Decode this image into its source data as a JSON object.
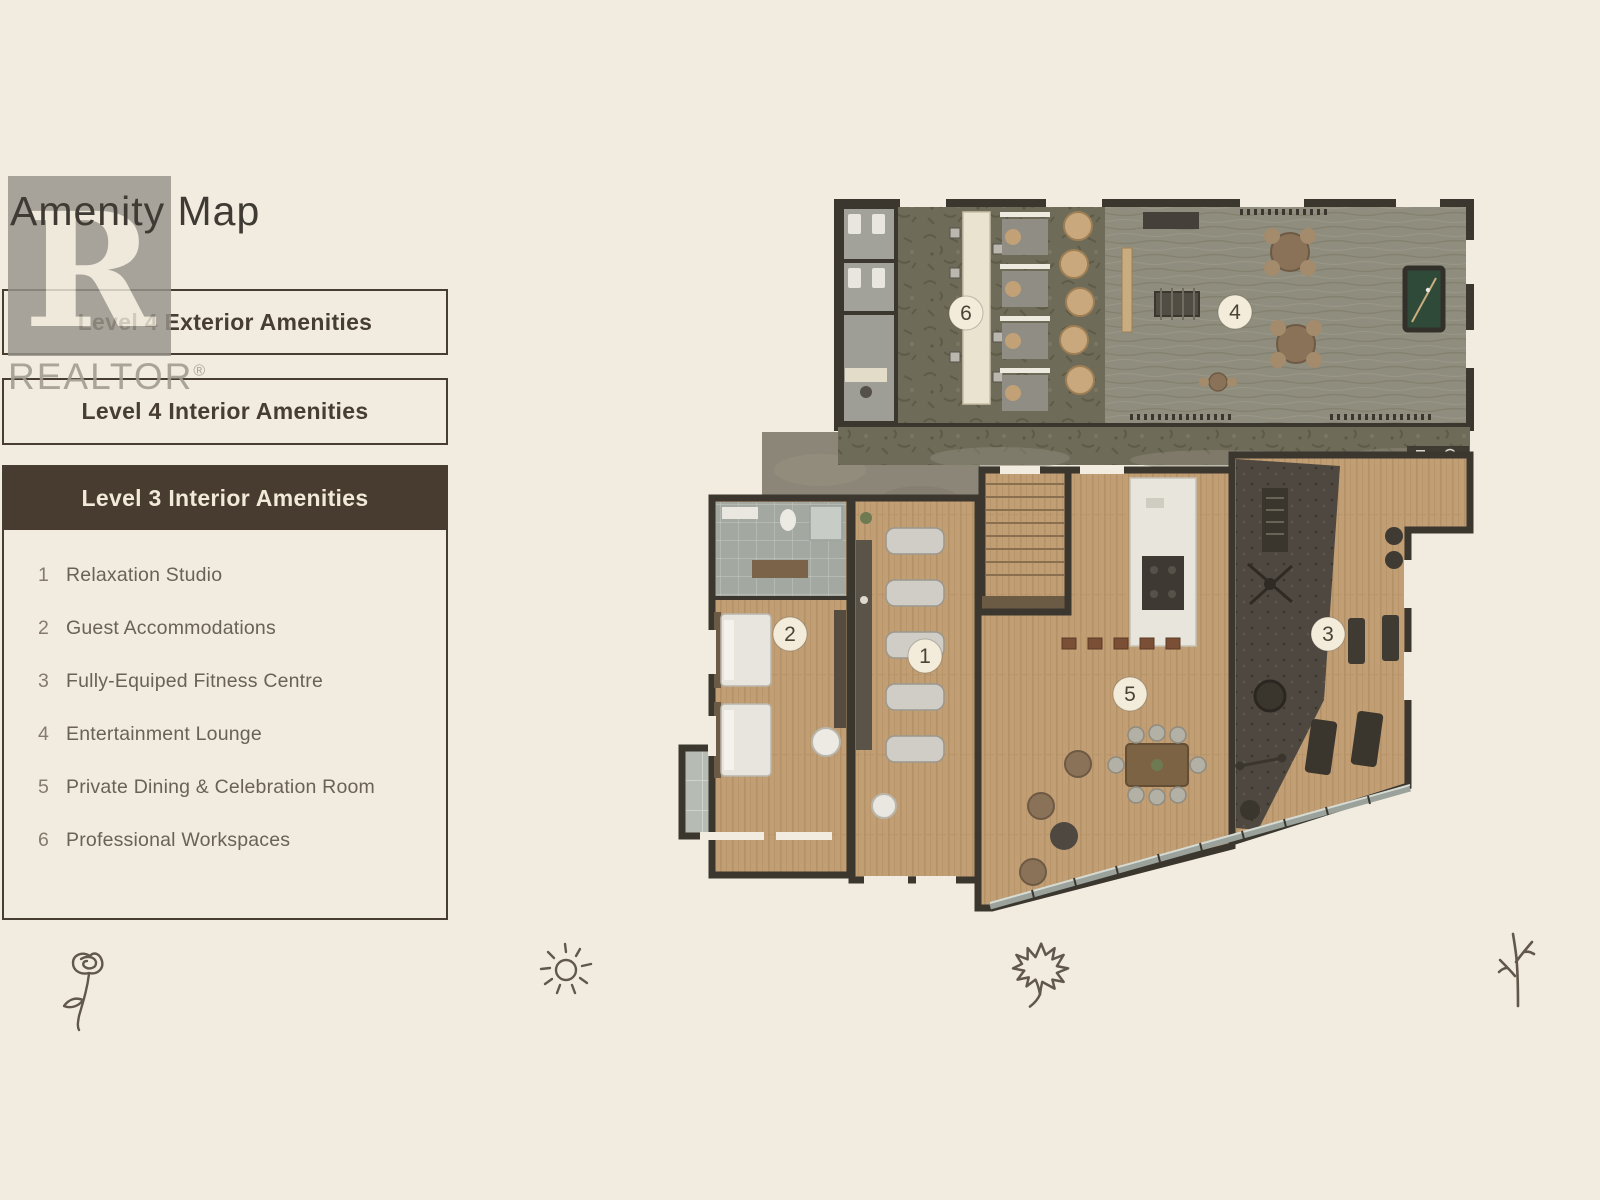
{
  "page": {
    "title": "Amenity Map"
  },
  "watermark": {
    "letter": "R",
    "label": "REALTOR",
    "registered": "®"
  },
  "tabs": [
    {
      "label": "Level 4 Exterior Amenities",
      "active": false
    },
    {
      "label": "Level 4 Interior Amenities",
      "active": false
    },
    {
      "label": "Level 3 Interior Amenities",
      "active": true
    }
  ],
  "legend": {
    "items": [
      {
        "num": "1",
        "label": "Relaxation Studio"
      },
      {
        "num": "2",
        "label": "Guest Accommodations"
      },
      {
        "num": "3",
        "label": "Fully-Equiped Fitness Centre"
      },
      {
        "num": "4",
        "label": "Entertainment Lounge"
      },
      {
        "num": "5",
        "label": "Private Dining & Celebration Room"
      },
      {
        "num": "6",
        "label": "Professional Workspaces"
      }
    ]
  },
  "floorplan": {
    "markers": [
      {
        "num": "1",
        "label": "Relaxation Studio"
      },
      {
        "num": "2",
        "label": "Guest Accommodations"
      },
      {
        "num": "3",
        "label": "Fully-Equiped Fitness Centre"
      },
      {
        "num": "4",
        "label": "Entertainment Lounge"
      },
      {
        "num": "5",
        "label": "Private Dining & Celebration Room"
      },
      {
        "num": "6",
        "label": "Professional Workspaces"
      }
    ]
  },
  "footer_icons": [
    "rose-icon",
    "sun-icon",
    "maple-leaf-icon",
    "branch-icon"
  ],
  "colors": {
    "background": "#f1ecdf",
    "accent_dark_brown": "#483b30",
    "panel_border": "#473d31",
    "wall": "#3b372f",
    "wood_floor": "#c19e74",
    "olive_carpet": "#6e6b59",
    "lounge_floor": "#8f8d7e",
    "gym_mat": "#4e4840",
    "pool_table_green": "#2f4a39",
    "marker_fill": "#f3ecda"
  }
}
